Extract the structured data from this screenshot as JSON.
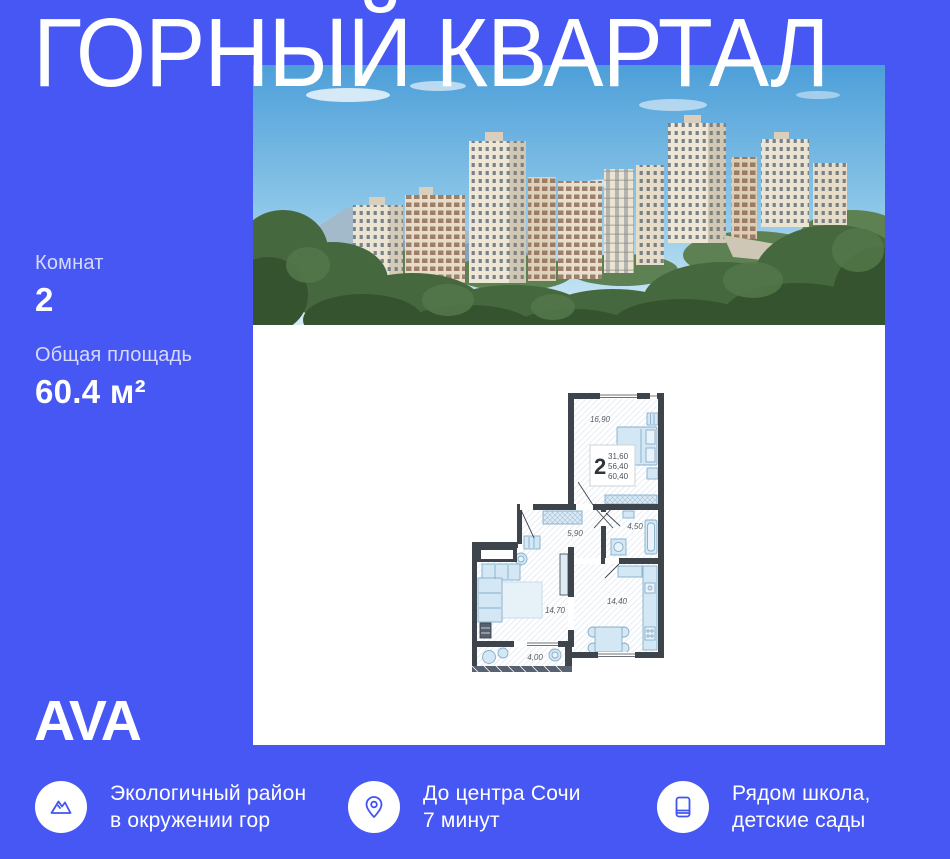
{
  "page": {
    "bg_color": "#4757f3",
    "accent_blue": "#4154f2"
  },
  "title": "ГОРНЫЙ КВАРТАЛ",
  "listing": {
    "rooms_label": "Комнат",
    "rooms_value": "2",
    "area_label": "Общая площадь",
    "area_value": "60.4 м²"
  },
  "brand": {
    "logo_text": "AVA"
  },
  "features": [
    {
      "icon": "mountain-icon",
      "line1": "Экологичный район",
      "line2": "в окружении гор"
    },
    {
      "icon": "location-pin-icon",
      "line1": "До центра Сочи",
      "line2": "7 минут"
    },
    {
      "icon": "book-icon",
      "line1": "Рядом школа,",
      "line2": "детские сады"
    }
  ],
  "floor_plan": {
    "stats": {
      "rooms": "2",
      "living_area": "31,60",
      "usable_area": "56,40",
      "total_area": "60,40"
    },
    "room_labels": {
      "bedroom": "16,90",
      "hallway": "5,90",
      "bathroom": "4,50",
      "living": "14,70",
      "kitchen": "14,40",
      "balcony": "4,00"
    }
  }
}
